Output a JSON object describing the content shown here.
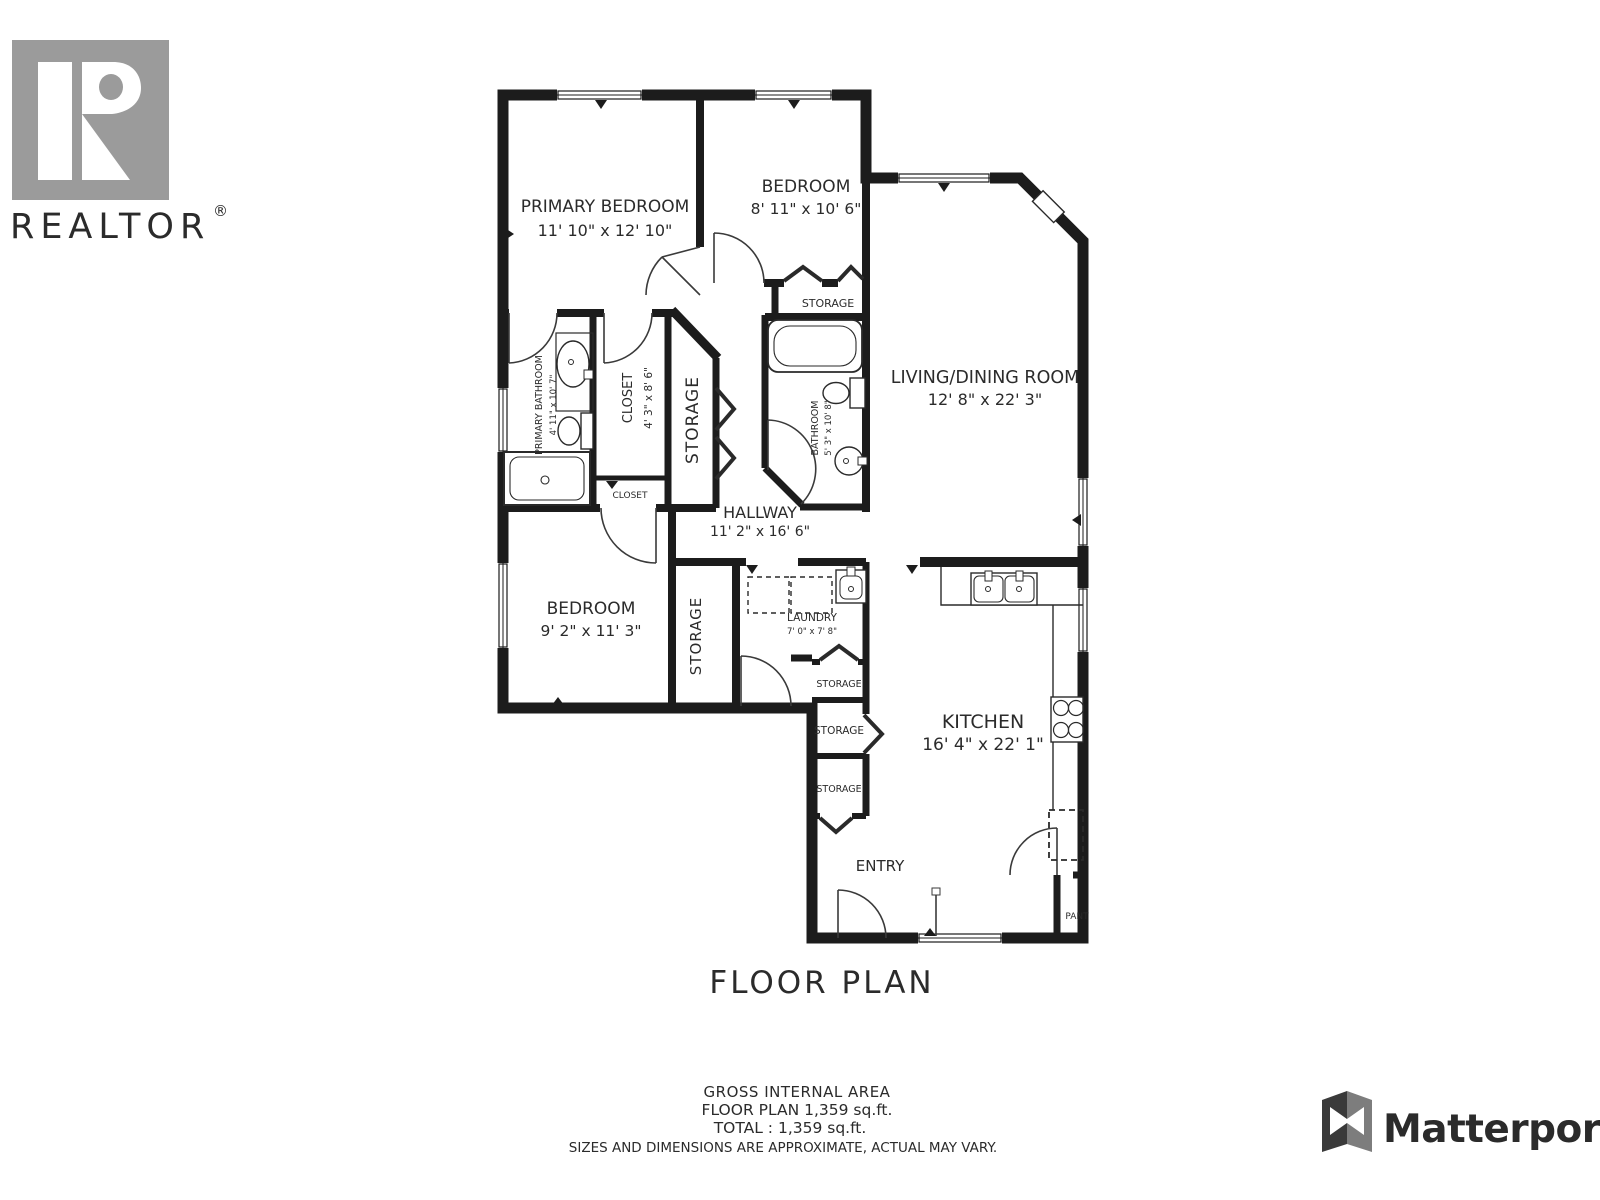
{
  "branding": {
    "realtor": {
      "word": "REALTOR",
      "registered": "®"
    },
    "matterport": {
      "word": "Matterport"
    }
  },
  "plan": {
    "title": "FLOOR PLAN",
    "rooms": {
      "primary_bedroom": {
        "name": "PRIMARY BEDROOM",
        "dims": "11' 10\" x 12' 10\""
      },
      "bedroom_top": {
        "name": "BEDROOM",
        "dims": "8' 11\" x 10' 6\""
      },
      "living_dining": {
        "name": "LIVING/DINING ROOM",
        "dims": "12' 8\" x 22' 3\""
      },
      "storage_bedroom_top": {
        "name": "STORAGE"
      },
      "primary_bathroom": {
        "name": "PRIMARY BATHROOM",
        "dims": "4' 11\" x 10' 7\""
      },
      "closet": {
        "name": "CLOSET",
        "dims": "4' 3\" x 8' 6\""
      },
      "storage_hall": {
        "name": "STORAGE"
      },
      "closet_small": {
        "name": "CLOSET"
      },
      "bathroom": {
        "name": "BATHROOM",
        "dims": "5' 3\" x 10' 8\""
      },
      "hallway": {
        "name": "HALLWAY",
        "dims": "11' 2\" x 16' 6\""
      },
      "bedroom_lower": {
        "name": "BEDROOM",
        "dims": "9' 2\" x 11' 3\""
      },
      "storage_bedroom_lower": {
        "name": "STORAGE"
      },
      "laundry": {
        "name": "LAUNDRY",
        "dims": "7' 0\" x 7' 8\""
      },
      "storage_stack_1": {
        "name": "STORAGE"
      },
      "storage_stack_2": {
        "name": "STORAGE"
      },
      "storage_stack_3": {
        "name": "STORAGE"
      },
      "kitchen": {
        "name": "KITCHEN",
        "dims": "16' 4\" x 22' 1\""
      },
      "entry": {
        "name": "ENTRY"
      },
      "pantry": {
        "name": "PANT"
      }
    }
  },
  "footer": {
    "area_title": "GROSS INTERNAL AREA",
    "floor_plan_area": "FLOOR PLAN 1,359 sq.ft.",
    "total_area": "TOTAL :  1,359 sq.ft.",
    "disclaimer": "SIZES AND DIMENSIONS ARE APPROXIMATE, ACTUAL MAY VARY."
  },
  "colors": {
    "wall": "#1c1c1c",
    "text": "#2b2b2b",
    "realtor_gray": "#9b9b9b",
    "matterport_dark": "#3a3a3a"
  }
}
